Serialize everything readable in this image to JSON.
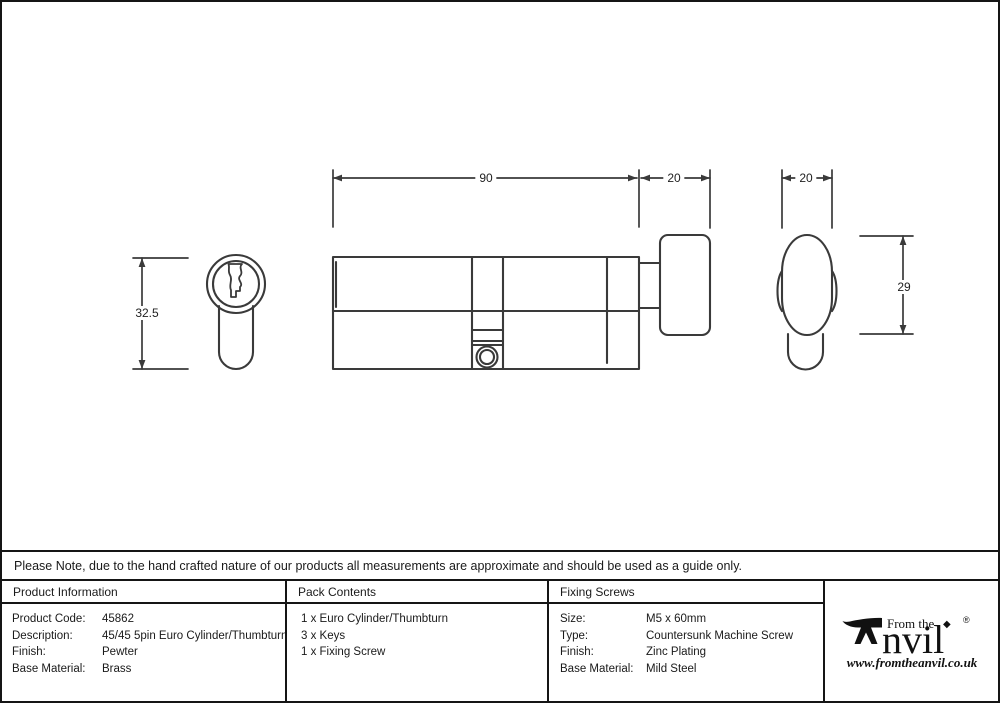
{
  "drawing": {
    "dimensions": {
      "front_height": "32.5",
      "body_length": "90",
      "knob_side_width": "20",
      "knob_end_width": "20",
      "knob_end_height": "29"
    }
  },
  "note": {
    "text": "Please Note, due to the hand crafted nature of our products all measurements are approximate and should be used as a guide only."
  },
  "table": {
    "product_information": {
      "header": "Product Information",
      "rows": [
        {
          "label": "Product Code:",
          "value": "45862"
        },
        {
          "label": "Description:",
          "value": "45/45 5pin Euro Cylinder/Thumbturn"
        },
        {
          "label": "Finish:",
          "value": "Pewter"
        },
        {
          "label": "Base Material:",
          "value": "Brass"
        }
      ]
    },
    "pack_contents": {
      "header": "Pack Contents",
      "items": [
        "1 x Euro Cylinder/Thumbturn",
        "3 x Keys",
        "1 x Fixing Screw"
      ]
    },
    "fixing_screws": {
      "header": "Fixing Screws",
      "rows": [
        {
          "label": "Size:",
          "value": "M5 x 60mm"
        },
        {
          "label": "Type:",
          "value": "Countersunk Machine Screw"
        },
        {
          "label": "Finish:",
          "value": "Zinc Plating"
        },
        {
          "label": "Base Material:",
          "value": "Mild Steel"
        }
      ]
    }
  },
  "logo": {
    "prefix": "From the",
    "wordmark_rest": "nvil",
    "diamond": "◆",
    "registered": "®",
    "url": "www.fromtheanvil.co.uk"
  },
  "colors": {
    "line": "#3a3a3a",
    "border": "#151515",
    "text": "#1a1a1a",
    "background": "#ffffff"
  }
}
